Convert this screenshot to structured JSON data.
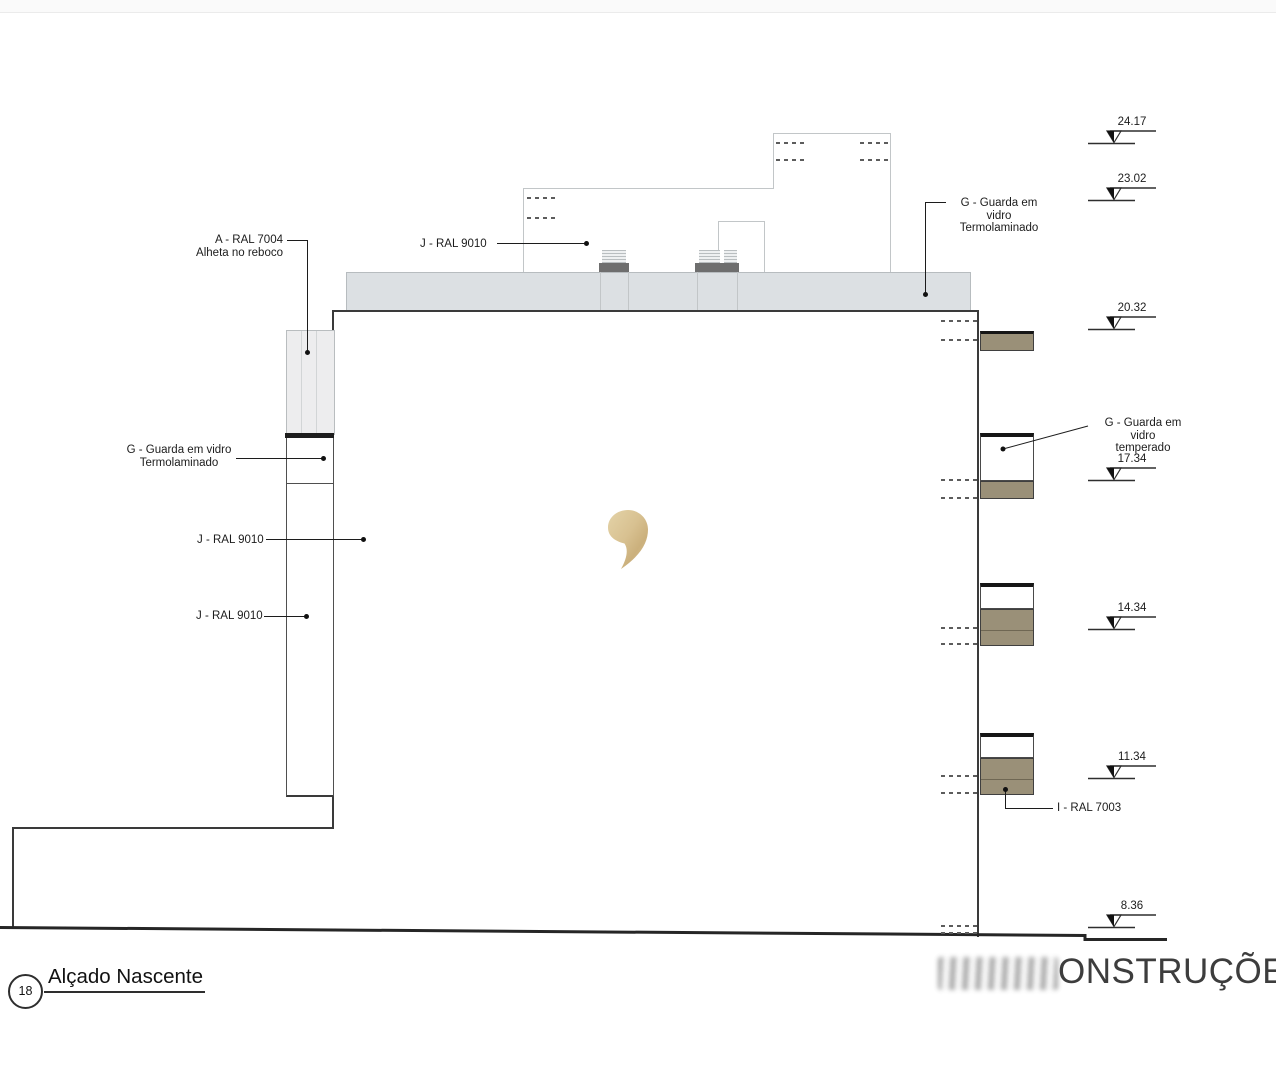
{
  "drawing": {
    "title": {
      "number": "18",
      "label": "Alçado Nascente"
    },
    "watermark": {
      "visible_text": "ONSTRUÇÕES"
    },
    "logo": {
      "name": "gold-comma-logo"
    },
    "levels": [
      {
        "value": "24.17"
      },
      {
        "value": "23.02"
      },
      {
        "value": "20.32"
      },
      {
        "value": "17.34"
      },
      {
        "value": "14.34"
      },
      {
        "value": "11.34"
      },
      {
        "value": "8.36"
      }
    ],
    "labels": {
      "a_ral_7004": {
        "line1": "A - RAL 7004",
        "line2": "Alheta no reboco"
      },
      "j_ral_9010_roof": {
        "text": "J - RAL 9010"
      },
      "g_vidro_left": {
        "line1": "G - Guarda em vidro",
        "line2": "Termolaminado"
      },
      "j_ral_9010_mid": {
        "text": "J - RAL 9010"
      },
      "j_ral_9010_low": {
        "text": "J - RAL 9010"
      },
      "g_vidro_top_right": {
        "line1": "G - Guarda em vidro",
        "line2": "Termolaminado"
      },
      "g_vidro_right": {
        "line1": "G - Guarda em vidro",
        "line2": "temperado"
      },
      "i_ral_7003": {
        "text": "I - RAL 7003"
      }
    },
    "colors": {
      "balcony_slab": "#9a9078",
      "parapet_band": "#dce0e3",
      "facade_panel": "#ededee",
      "chimney_cap": "#6e6e6e",
      "logo_gold": "#d8c191",
      "line_dark": "#3a3a3a",
      "line_light": "#c2c6c8"
    }
  }
}
